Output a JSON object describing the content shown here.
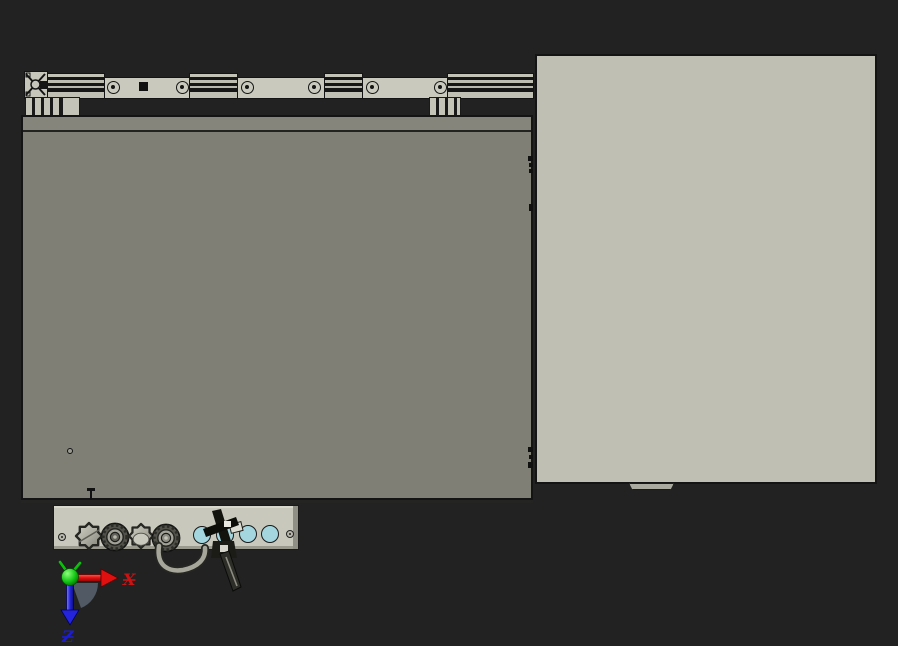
{
  "viewport": {
    "type": "3d-cad-view",
    "view_description": "orthographic side view of a machine assembly: extrusion rail on top, gray enclosure, light side panel, bottom connector panel with knobs"
  },
  "triad": {
    "x_label": "X",
    "z_label": "Z",
    "x_color": "#cc1212",
    "z_color": "#1d1dcf",
    "origin_color": "#00bb00"
  },
  "colors": {
    "bg_top": "#06fbfb",
    "bg_bottom": "#c8c7d1",
    "enclosure_face": "#7f7f76",
    "enclosure_band": "#85857b",
    "side_panel": "#bfbfb4",
    "rail_plate": "#c9c9be",
    "bottom_panel": "#c8c8bd",
    "hole_fill": "#a3d6de",
    "edge_line": "#141414"
  },
  "parts": {
    "rail": "top extrusion rail with guide",
    "rail_screw_count": 6,
    "enclosure": "main enclosure box",
    "side_panel": "side cover panel",
    "bottom_panel": "connector panel",
    "knob_count": 4,
    "hole_count": 4,
    "lever": "clamp lever",
    "cable": "cable loop"
  }
}
